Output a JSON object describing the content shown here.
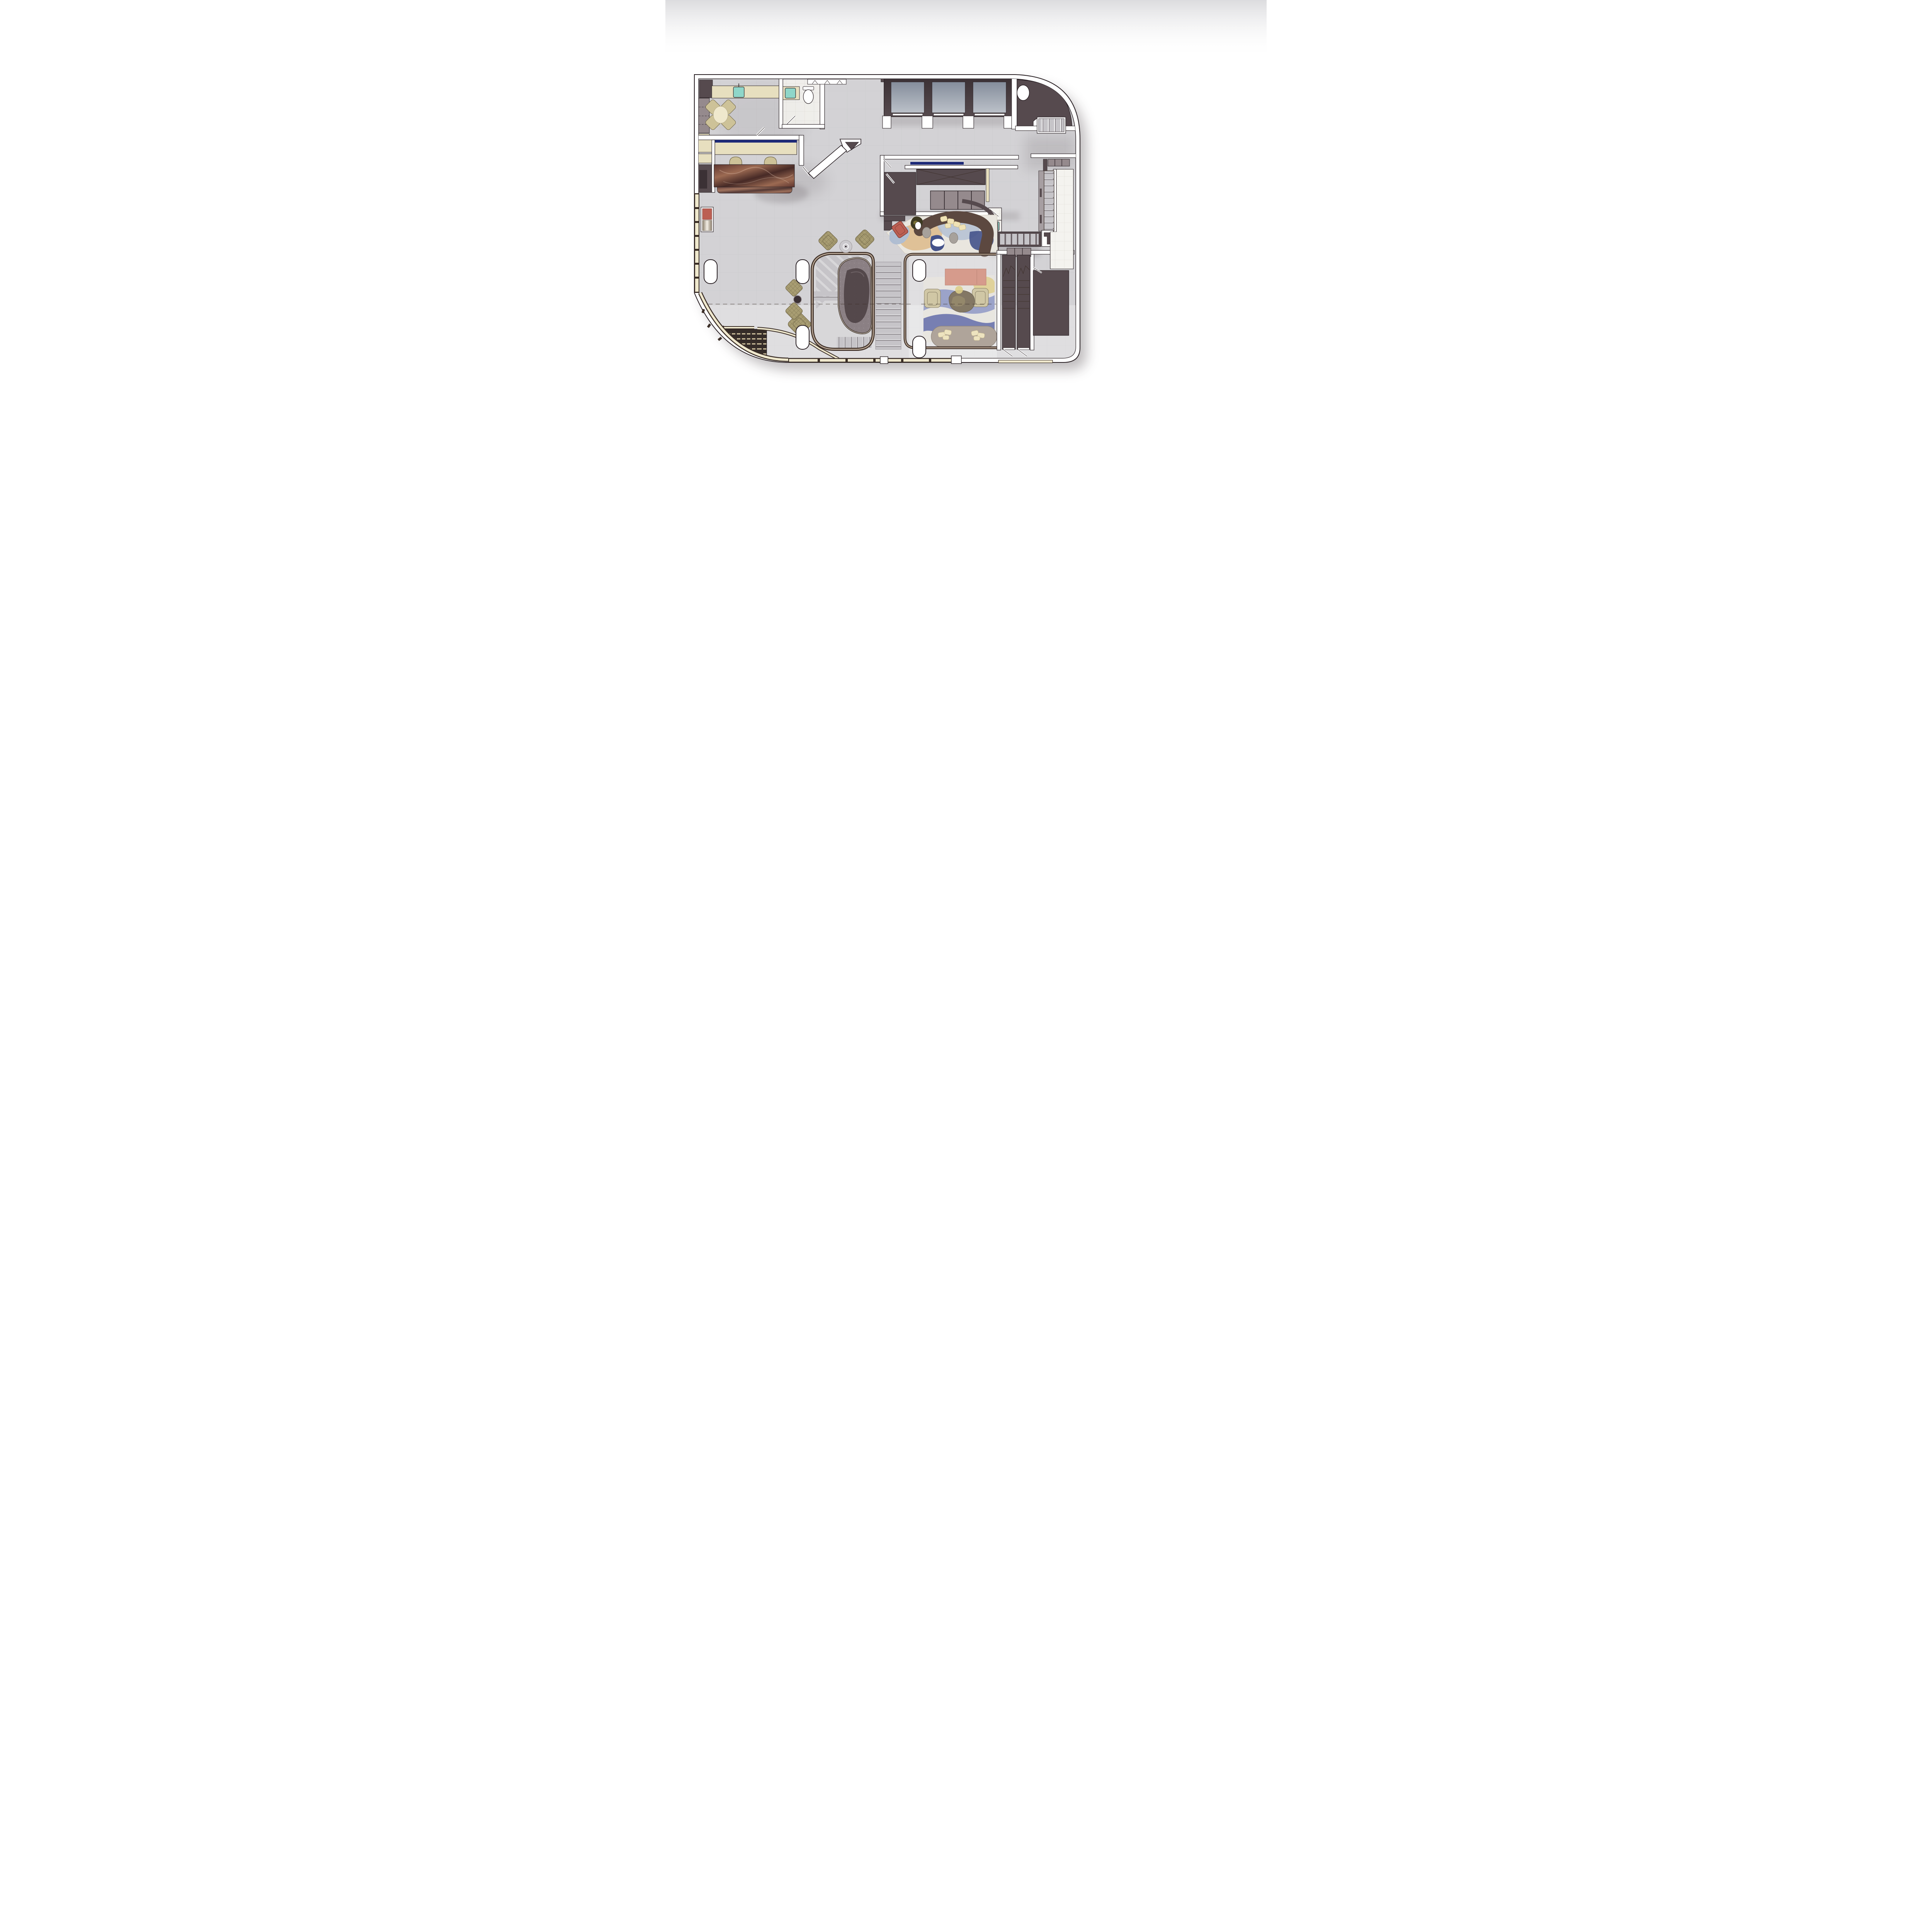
{
  "document": {
    "kind": "architectural-floor-plan",
    "view": "top-down rendered plan of a lobby floor",
    "visible_text": []
  },
  "palette": {
    "page_bg": "#ffffff",
    "ambient": "#d0d0d3",
    "outline": "#2a2125",
    "wall": "#ffffff",
    "floor": "#d3d2d5",
    "floor_line": "#bdbcc1",
    "shadow_col": "#4a3f44",
    "dark_room": "#564a4e",
    "dark_deep": "#3b3135",
    "cab_grey": "#958a8d",
    "elevator_cab_a": "#848d9b",
    "elevator_cab_b": "#bcc1c9",
    "white_tile": "#f4f3ef",
    "tile_line": "#d9d6d0",
    "beige": "#e7dfbf",
    "cream": "#efe8cd",
    "navy": "#1d2a78",
    "bronze": "#77604f",
    "bronze_dark": "#3a2d26",
    "rail_light": "#e4dccf",
    "step": "#c6c4c8",
    "step_gap": "#8f8a8f",
    "marble_a": "#5e352f",
    "marble_b": "#9c6a52",
    "marble_c": "#472a26",
    "chair_tan": "#cdc298",
    "fabric": "#a89d72",
    "fabric_dark": "#6f6546",
    "red_chair": "#bc5f53",
    "salmon": "#d58d7a",
    "mint": "#8fd6c9",
    "mat": "#352c28",
    "mat_stripe": "#d6c9a4",
    "sofa_brown": "#5c4840",
    "pillow": "#efe2b6",
    "pouf": "#a7a19b",
    "rug_base": "#e9e6df",
    "rug_blue": "#aebcd2",
    "rug_tan": "#dfc094",
    "rug_navy": "#3c4b86",
    "lrug_blue": "#8d96c4",
    "lrug_navy": "#46529e",
    "lrug_yellow": "#ddcb77",
    "stone": "#6f6149",
    "plant": "#3e3a22"
  },
  "regions": [
    "break-room",
    "restroom",
    "coat-closet",
    "back-office",
    "reception-desk",
    "lobby-floor",
    "elevator-bank",
    "corner-shaft-room",
    "service-core",
    "luggage-shaft",
    "storage-room",
    "sunken-lounge-stair",
    "grand-stair",
    "upper-lounge",
    "lower-lounge",
    "entry-vestibule",
    "back-stair",
    "tiled-corridor",
    "stair-shafts",
    "plant-room",
    "curtain-wall"
  ],
  "inventory": {
    "elevators": 3,
    "stair_flights": 6,
    "stair_shafts_down": 2,
    "column_pills": 6,
    "entry_mat_stripes": 11,
    "upper_lounge_pillows": 5,
    "lower_lounge_pillows": 6,
    "fabric_armchairs": 4,
    "dining_chairs": 4,
    "reception_chairs": 2,
    "elevator_lobby_piers": 4,
    "service_cabinet_segments": 4
  }
}
